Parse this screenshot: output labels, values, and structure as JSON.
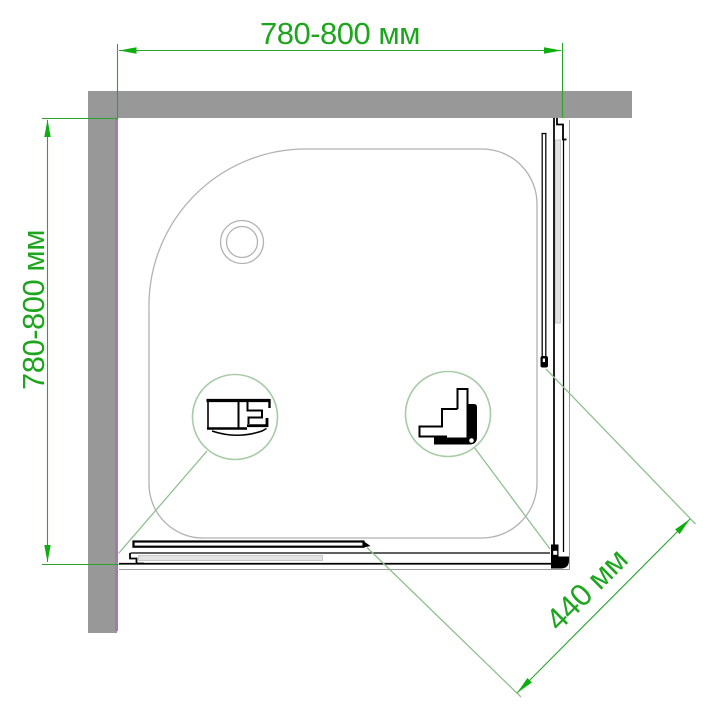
{
  "diagram": {
    "type": "shower-enclosure-top-view-installation-drawing",
    "dimensions": {
      "width": "780-800 мм",
      "depth": "780-800 мм",
      "door_opening": "440 мм"
    },
    "callouts": [
      {
        "name": "wall-profile-section-detail"
      },
      {
        "name": "corner-profile-section-detail"
      }
    ],
    "colors": {
      "dimension_green": "#1ea51e",
      "arrow_green": "#0fae0f",
      "leader_pale_green": "#8fbf8f",
      "callout_circle_green": "#a6cba6",
      "wall_gray": "#989898",
      "wall_accent_purple": "#a47ba8",
      "tray_outline_gray": "#b2b2b2",
      "frame_gray": "#9c9c9c",
      "profile_black": "#000000",
      "glass_gray": "#e3e3e3",
      "background": "#ffffff"
    }
  }
}
